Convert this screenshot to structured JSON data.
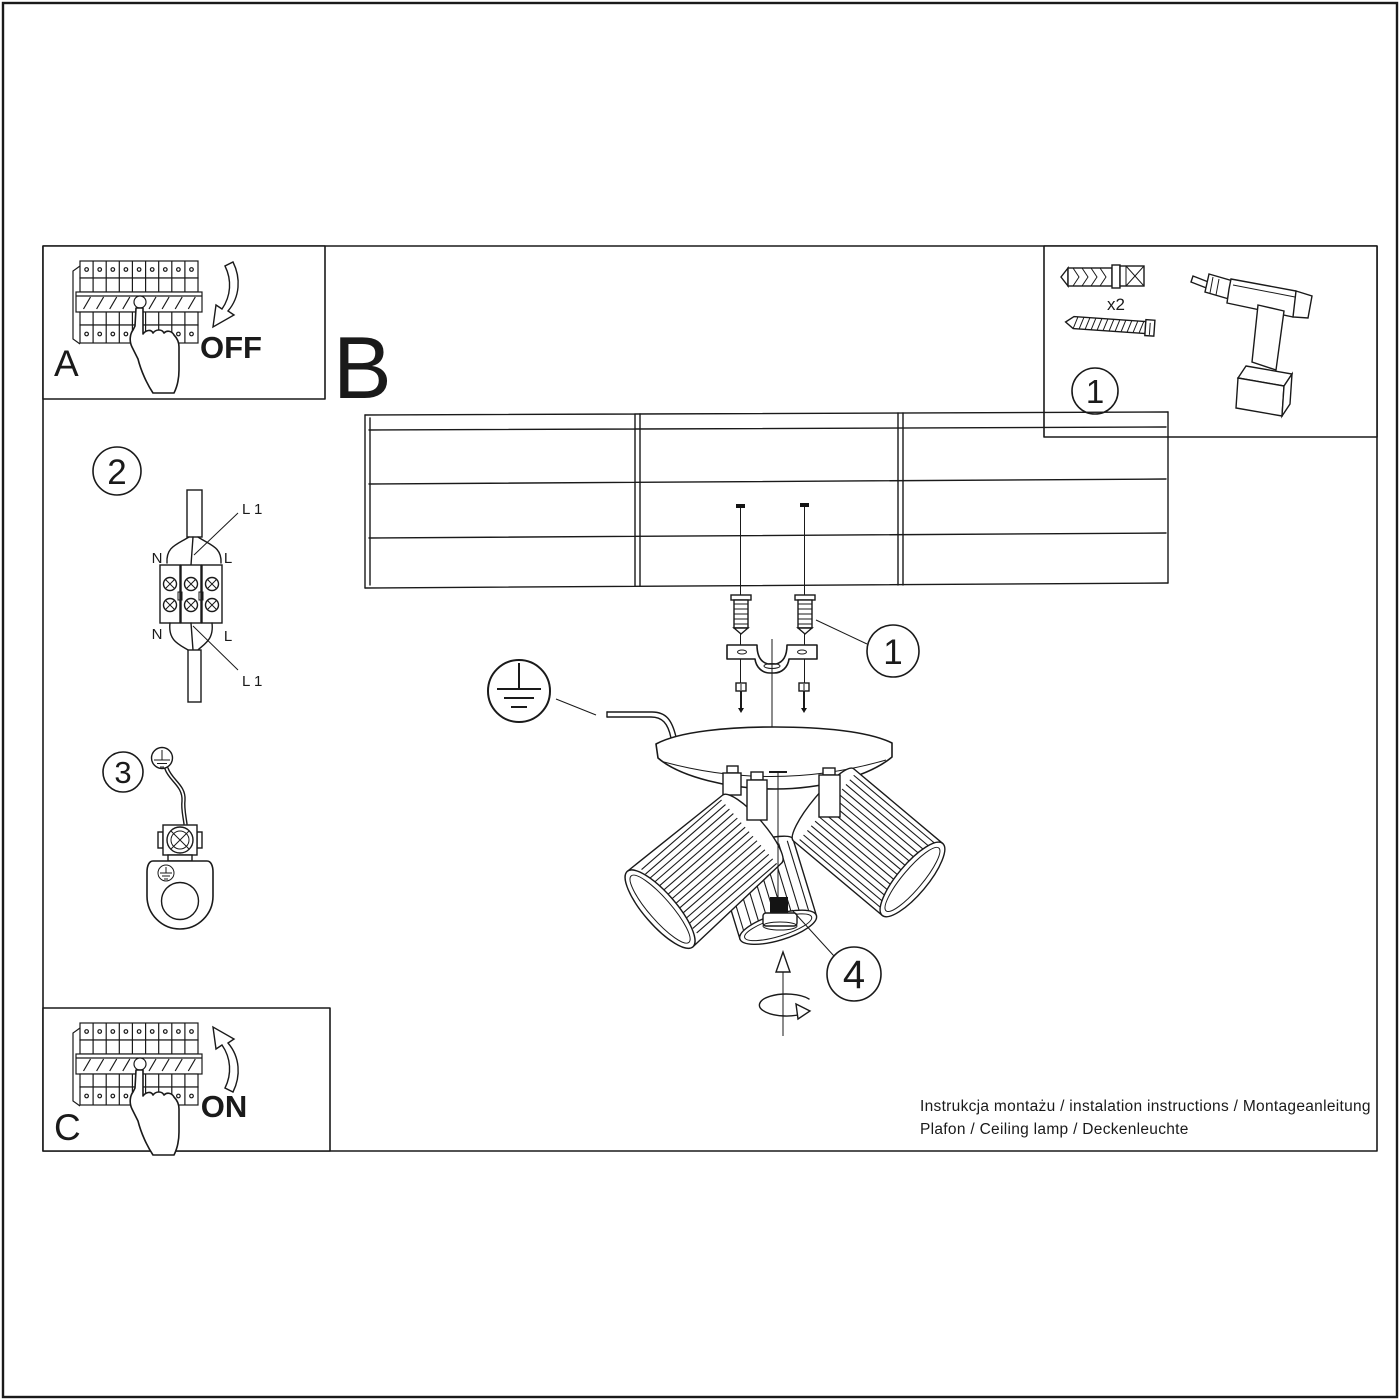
{
  "colors": {
    "ink": "#1a1a1a",
    "paper": "#ffffff"
  },
  "boxes": {
    "a": {
      "label": "A",
      "action": "OFF"
    },
    "b": {
      "label": "B"
    },
    "c": {
      "label": "C",
      "action": "ON"
    },
    "tools": {
      "step_number": "1",
      "dowel_qty": "x2"
    }
  },
  "callouts": {
    "bracket_step": "1",
    "wiring_step": "2",
    "ground_step": "3",
    "adjust_step": "4"
  },
  "wiring_labels": {
    "top_left": "N",
    "top_right": "L",
    "bottom_left": "N",
    "bottom_right": "L",
    "l1_top": "L 1",
    "l1_bottom": "L 1"
  },
  "footer": {
    "line1": "Instrukcja montażu / instalation instructions / Montageanleitung",
    "line2": "Plafon / Ceiling lamp / Deckenleuchte"
  }
}
